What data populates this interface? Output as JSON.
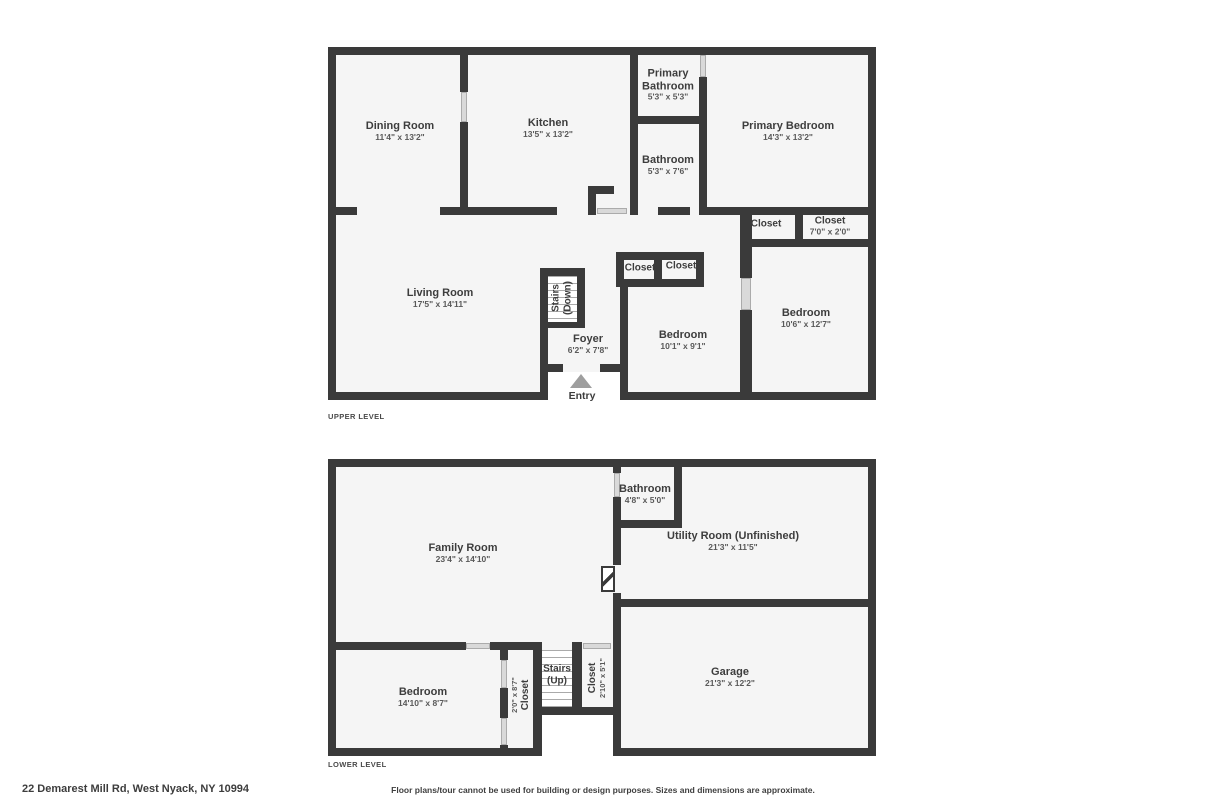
{
  "footer": {
    "address": "22 Demarest Mill Rd, West Nyack, NY 10994",
    "disclaimer": "Floor plans/tour cannot be used for building or design purposes. Sizes and dimensions are approximate."
  },
  "upper": {
    "level_label": "UPPER LEVEL",
    "rooms": {
      "dining": {
        "name": "Dining Room",
        "dims": "11'4\" x 13'2\""
      },
      "kitchen": {
        "name": "Kitchen",
        "dims": "13'5\" x 13'2\""
      },
      "primary_bath": {
        "name": "Primary Bathroom",
        "dims": "5'3\" x 5'3\""
      },
      "primary_bedroom": {
        "name": "Primary Bedroom",
        "dims": "14'3\" x 13'2\""
      },
      "bathroom": {
        "name": "Bathroom",
        "dims": "5'3\" x 7'6\""
      },
      "living": {
        "name": "Living Room",
        "dims": "17'5\" x 14'11\""
      },
      "stairs": {
        "name": "Stairs",
        "dir": "(Down)"
      },
      "foyer": {
        "name": "Foyer",
        "dims": "6'2\" x 7'8\""
      },
      "closet_a": {
        "name": "Closet"
      },
      "closet_b": {
        "name": "Closet"
      },
      "closet_c": {
        "name": "Closet"
      },
      "closet_d": {
        "name": "Closet",
        "dims": "7'0\" x 2'0\""
      },
      "bedroom_mid": {
        "name": "Bedroom",
        "dims": "10'1\" x 9'1\""
      },
      "bedroom_right": {
        "name": "Bedroom",
        "dims": "10'6\" x 12'7\""
      },
      "entry": {
        "name": "Entry"
      }
    }
  },
  "lower": {
    "level_label": "LOWER LEVEL",
    "rooms": {
      "family": {
        "name": "Family Room",
        "dims": "23'4\" x 14'10\""
      },
      "bathroom": {
        "name": "Bathroom",
        "dims": "4'8\" x 5'0\""
      },
      "utility": {
        "name": "Utility Room (Unfinished)",
        "dims": "21'3\" x 11'5\""
      },
      "bedroom": {
        "name": "Bedroom",
        "dims": "14'10\" x 8'7\""
      },
      "closet_a": {
        "name": "Closet",
        "dims": "2'0\" x 8'7\""
      },
      "stairs": {
        "name": "Stairs",
        "dir": "(Up)"
      },
      "closet_b": {
        "name": "Closet",
        "dims": "2'10\" x 5'1\""
      },
      "garage": {
        "name": "Garage",
        "dims": "21'3\" x 12'2\""
      }
    }
  },
  "colors": {
    "wall": "#3a3a3a",
    "floor": "#f5f5f5",
    "label_text": "#3d3d3d",
    "dims_text": "#595959",
    "window_border": "#9b9b9b",
    "entry_arrow": "#9e9e9e"
  }
}
